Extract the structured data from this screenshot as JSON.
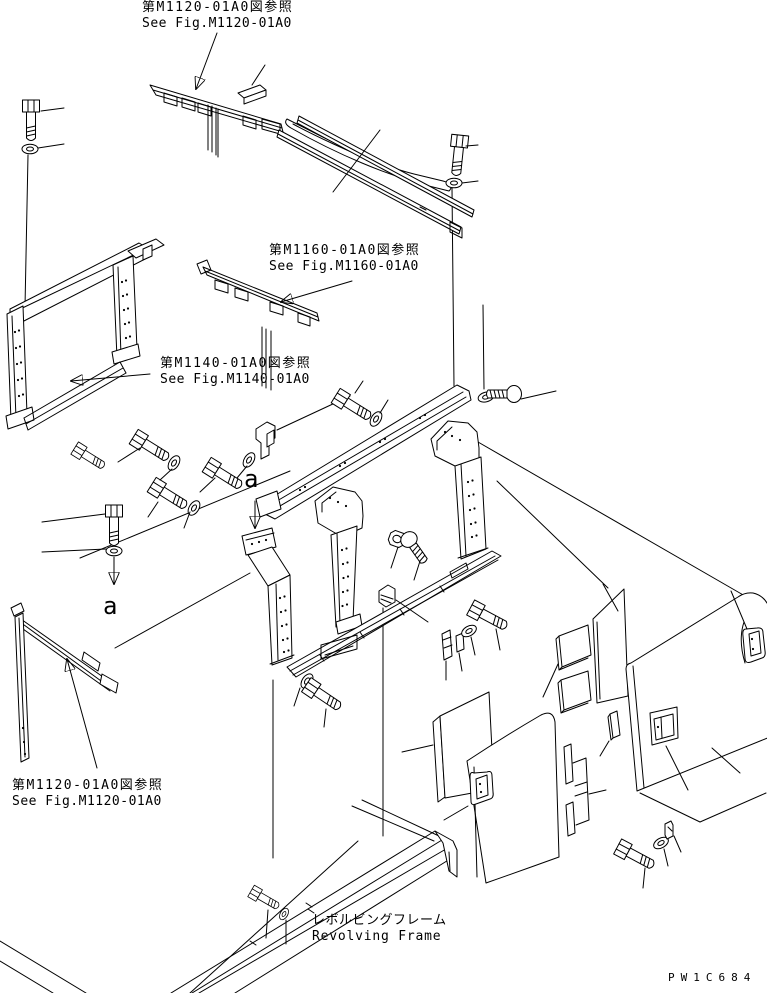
{
  "diagram": {
    "background_color": "#ffffff",
    "line_color": "#000000",
    "part_code": "PW1C684",
    "section_markers": {
      "upper": "a",
      "lower": "a"
    },
    "references": {
      "top": {
        "jp": "第M1120-01A0図参照",
        "en": "See Fig.M1120-01A0"
      },
      "middle": {
        "jp": "第M1160-01A0図参照",
        "en": "See Fig.M1160-01A0"
      },
      "left": {
        "jp": "第M1140-01A0図参照",
        "en": "See Fig.M1140-01A0"
      },
      "bottom": {
        "jp": "第M1120-01A0図参照",
        "en": "See Fig.M1120-01A0"
      }
    },
    "base_label": {
      "jp": "レボルビングフレーム",
      "en": "Revolving Frame"
    }
  }
}
